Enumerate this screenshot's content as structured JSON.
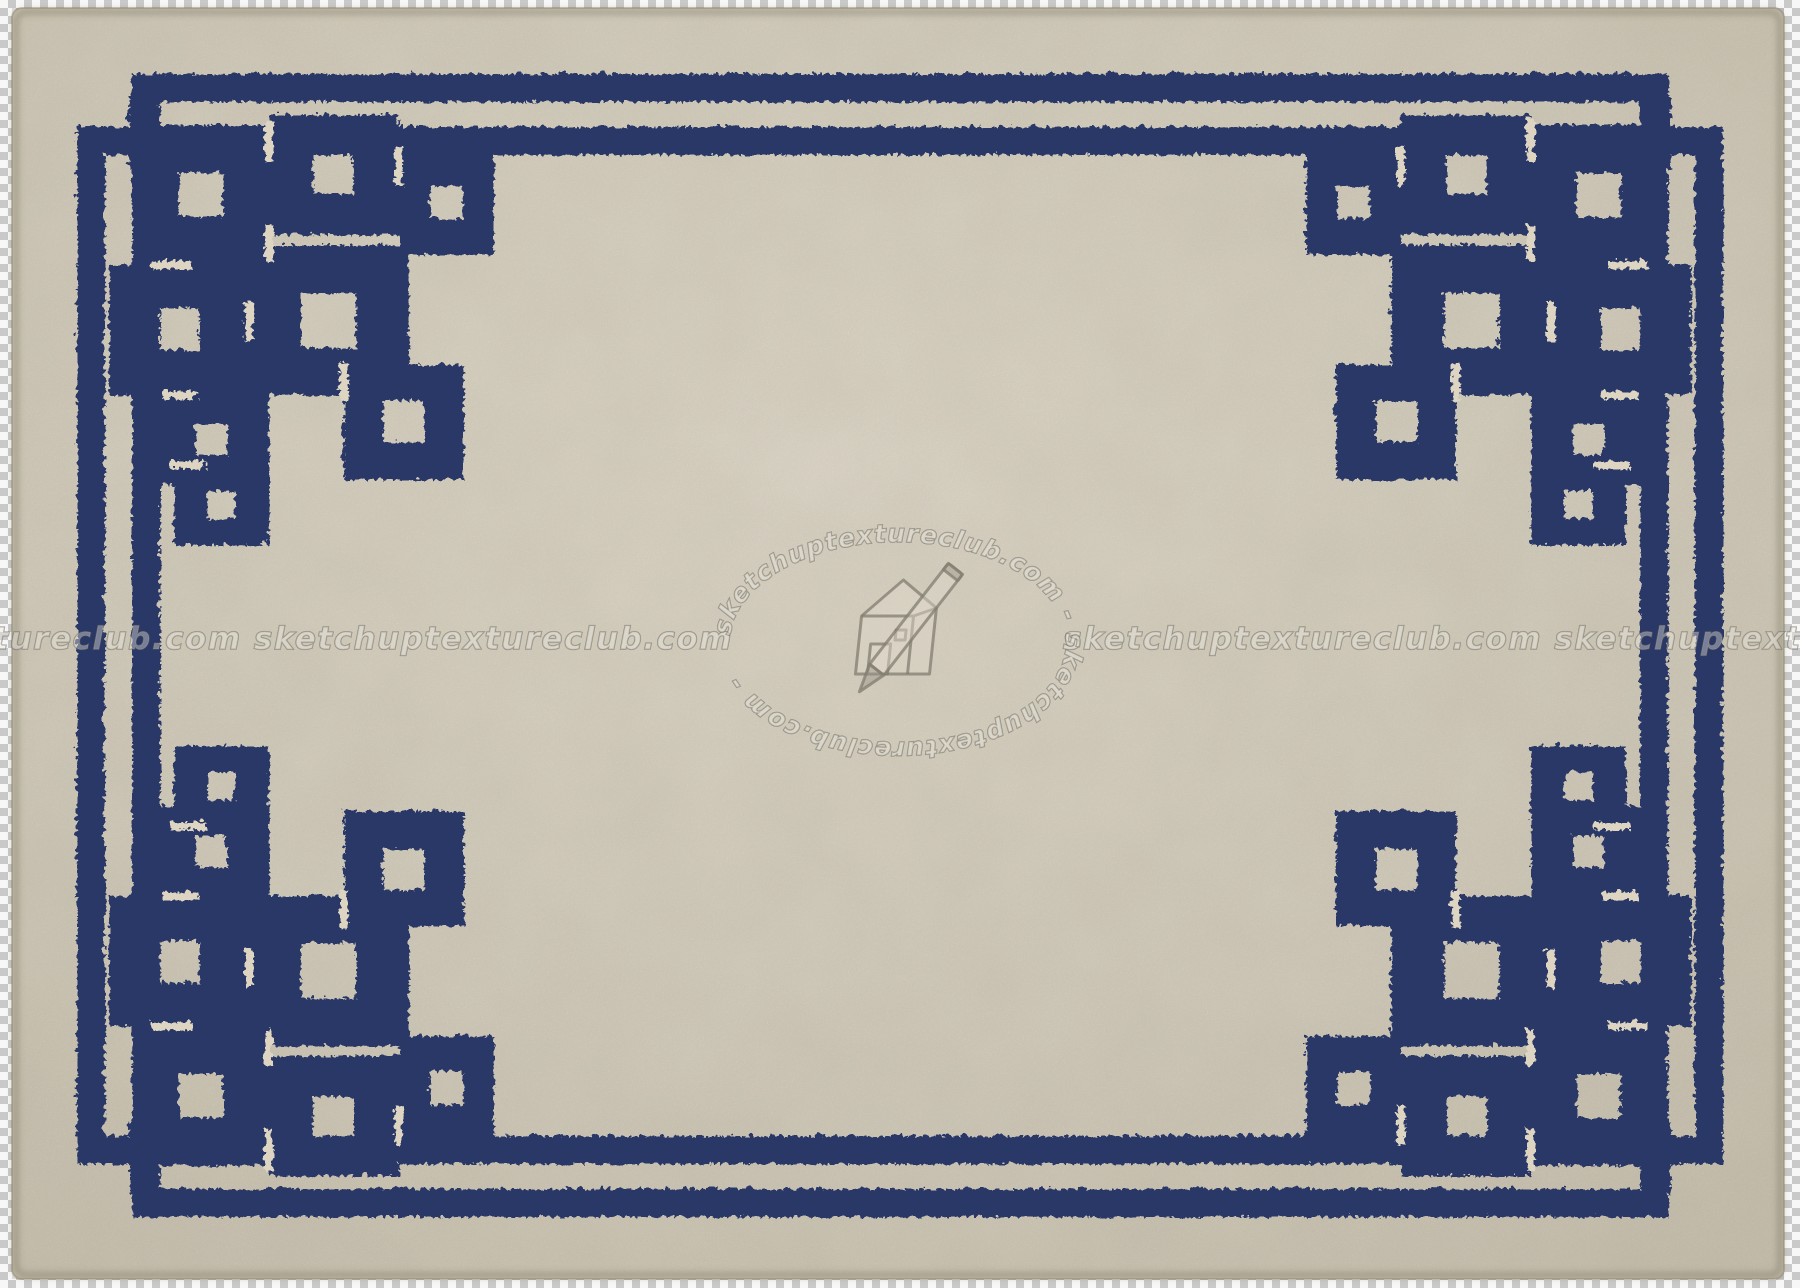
{
  "image": {
    "subject": "Cream wool rug texture with interlaced navy blue Greek key fretwork double border and knot corner motifs, shown over a transparency checkerboard",
    "colors": {
      "rug_base": "#ddd5c1",
      "rug_light": "#eae2d0",
      "rug_dark": "#cdc4ae",
      "border_navy": "#2a3768",
      "checker_dark": "#c9c9c9",
      "checker_light": "#f7f7f7",
      "watermark_ink": "#68635 7"
    }
  },
  "watermark": {
    "site": "sketchuptextureclub.com",
    "band_left": "sketchuptextureclub.com sketchuptextureclub.com",
    "band_right": "sketchuptextureclub.com sketchuptextureclub.com",
    "oval_text": "sketchuptextureclub.com   -   sketchuptextureclub.com   -",
    "logo": "sketchup house and pencil"
  }
}
